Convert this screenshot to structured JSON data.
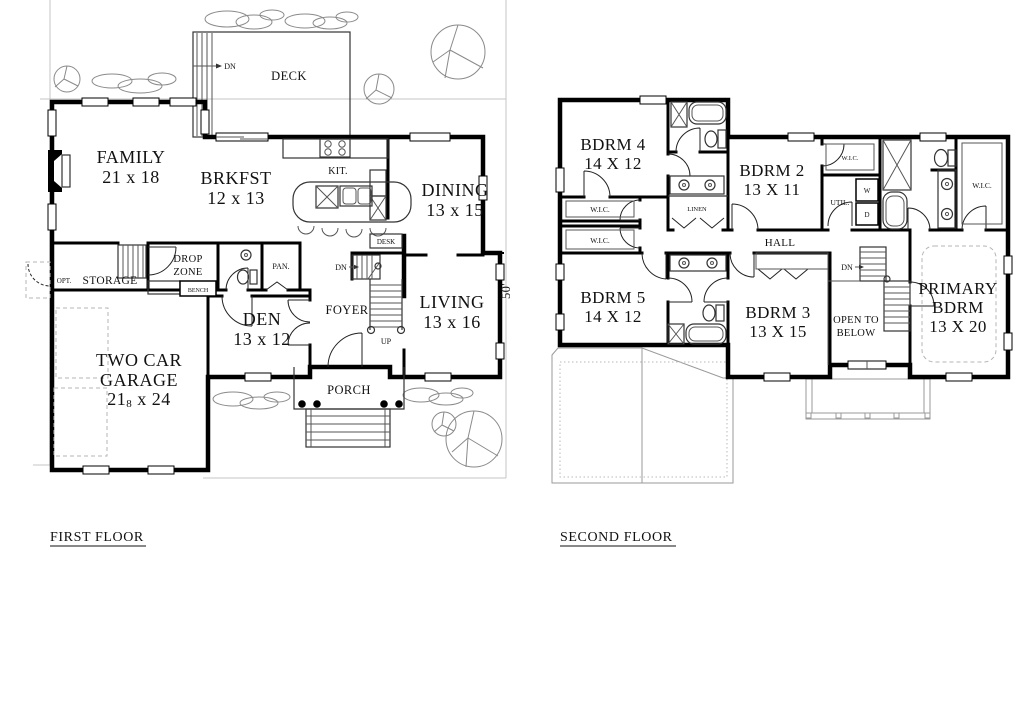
{
  "ff": {
    "caption": "FIRST FLOOR",
    "family_name": "FAMILY",
    "family_dim": "21 x 18",
    "brkfst_name": "BRKFST",
    "brkfst_dim": "12 x 13",
    "kit": "KIT.",
    "dining_name": "DINING",
    "dining_dim": "13 x 15",
    "living_name": "LIVING",
    "living_dim": "13 x 16",
    "den_name": "DEN",
    "den_dim": "13 x 12",
    "foyer": "FOYER",
    "garage_l1": "TWO CAR",
    "garage_l2": "GARAGE",
    "garage_dim_a": "21",
    "garage_dim_sub": "8",
    "garage_dim_b": " x 24",
    "deck": "DECK",
    "deck_dn": "DN",
    "porch": "PORCH",
    "opt": "OPT.",
    "storage": "STORAGE",
    "drop_l1": "DROP",
    "drop_l2": "ZONE",
    "bench": "BENCH",
    "pan": "PAN.",
    "desk": "DESK",
    "up": "UP",
    "dn": "DN",
    "dim_50": "50'"
  },
  "sf": {
    "caption": "SECOND FLOOR",
    "bdrm4_name": "BDRM 4",
    "bdrm4_dim": "14 X 12",
    "bdrm2_name": "BDRM 2",
    "bdrm2_dim": "13 X 11",
    "bdrm5_name": "BDRM 5",
    "bdrm5_dim": "14 X 12",
    "bdrm3_name": "BDRM 3",
    "bdrm3_dim": "13 X 15",
    "primary_l1": "PRIMARY",
    "primary_l2": "BDRM",
    "primary_dim": "13 X 20",
    "hall": "HALL",
    "linen": "LINEN",
    "util": "UTIL.",
    "washer": "W",
    "dryer": "D",
    "wic": "W.I.C.",
    "open_l1": "OPEN TO",
    "open_l2": "BELOW",
    "dn": "DN"
  }
}
